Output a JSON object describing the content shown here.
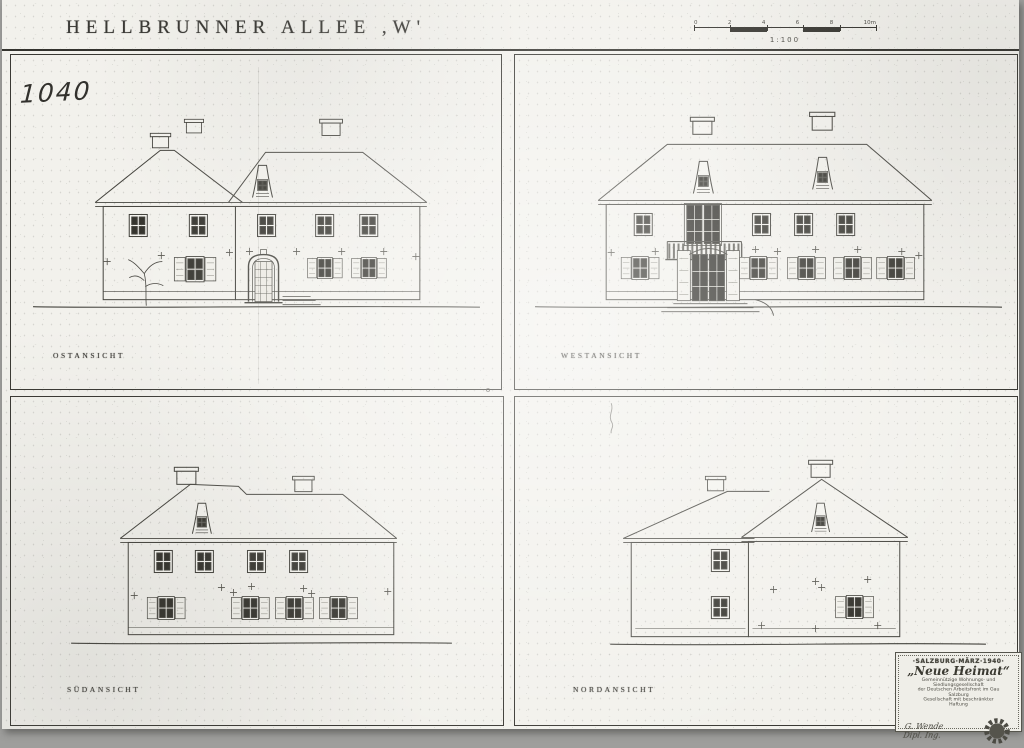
{
  "colors": {
    "paper": "#f2f1ec",
    "ink": "#3a3934",
    "scan_edge": "#9e9e9c"
  },
  "page": {
    "title": "HELLBRUNNER ALLEE ,W'",
    "number": "1040",
    "stray_mark": "o",
    "scale": {
      "label": "1:100",
      "ticks": [
        "0",
        "2",
        "4",
        "6",
        "8",
        "10m"
      ]
    }
  },
  "panels": [
    {
      "label": "OSTANSICHT"
    },
    {
      "label": "WESTANSICHT"
    },
    {
      "label": "SÜDANSICHT"
    },
    {
      "label": "NORDANSICHT"
    }
  ],
  "stamp": {
    "header": "·SALZBURG·MÄRZ·1940·",
    "company": "„Neue Heimat“",
    "body": [
      "Gemeinnützige Wohnungs- und Siedlungsgesellschaft",
      "der Deutschen Arbeitsfront im Gau Salzburg",
      "Gesellschaft mit beschränkter Haftung"
    ],
    "signature": "G. Wende",
    "signature_title": "Dipl. Ing."
  }
}
